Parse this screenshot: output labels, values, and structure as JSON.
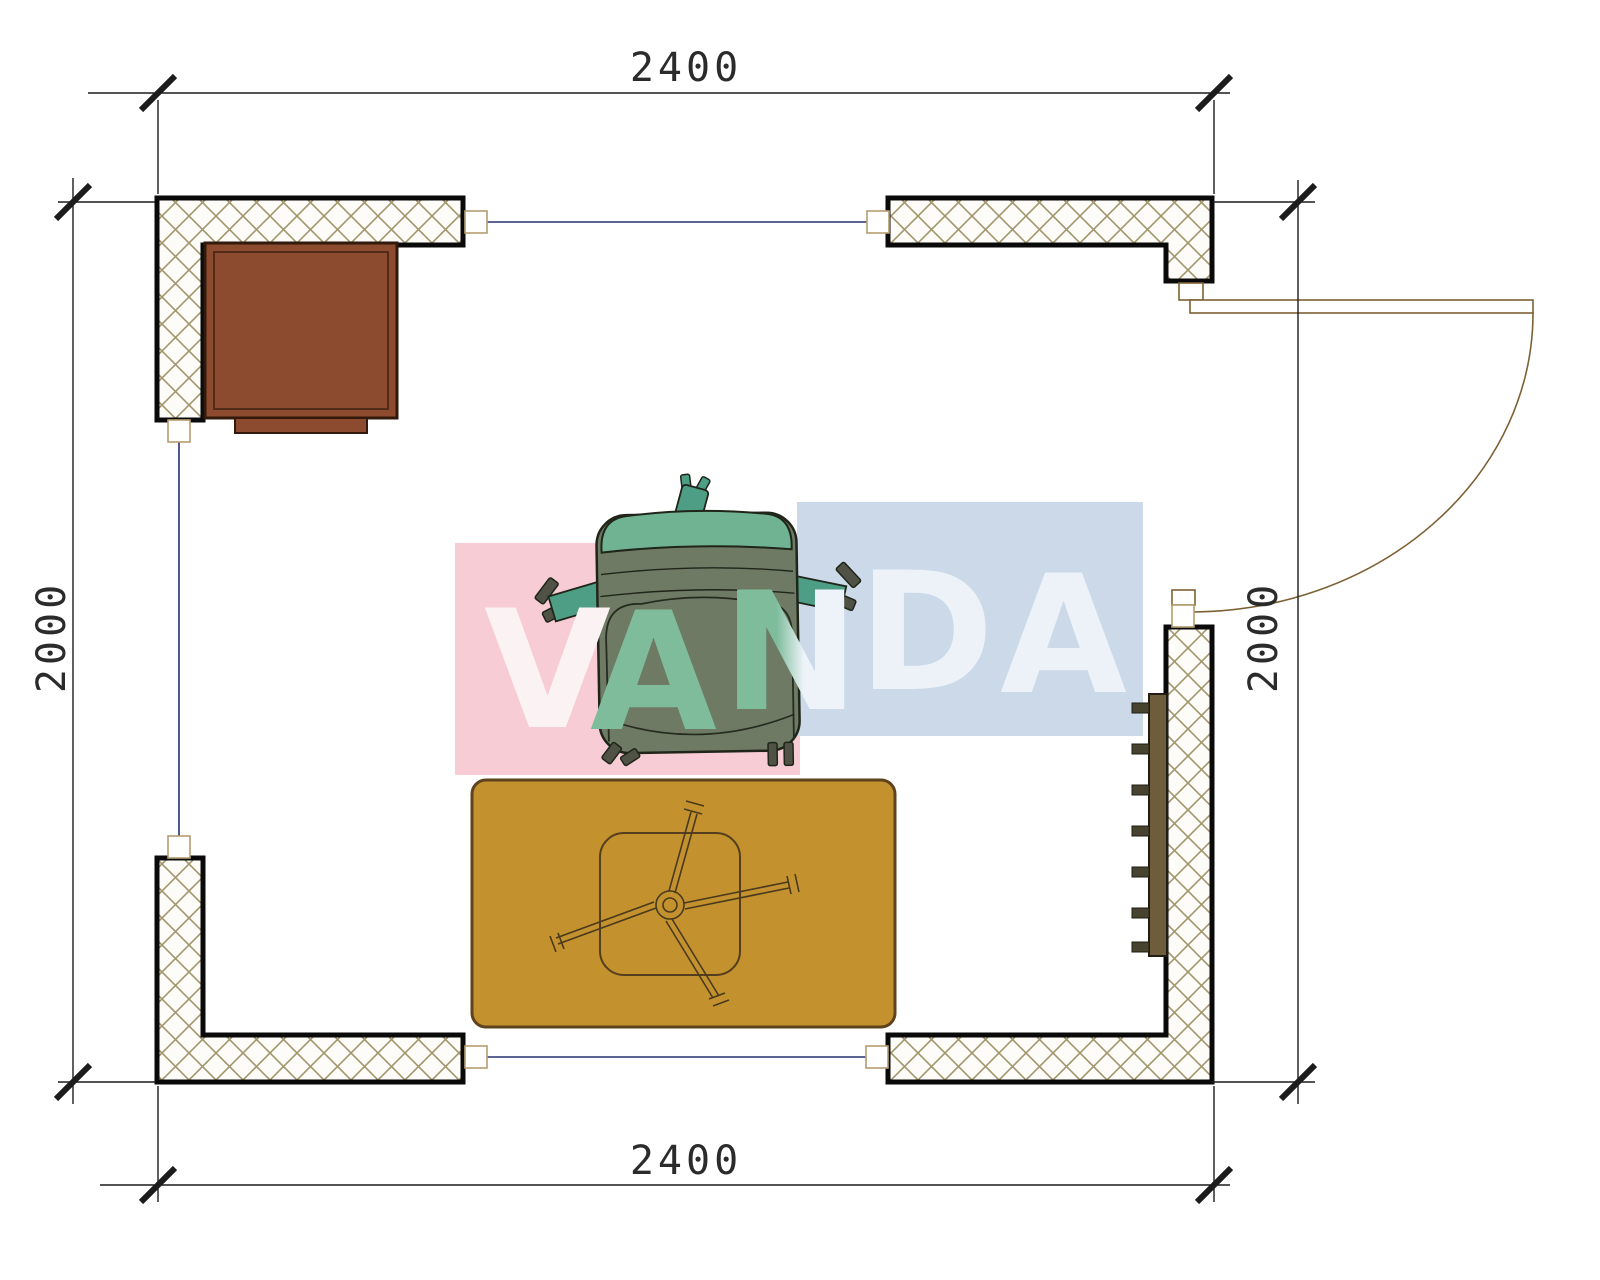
{
  "plan": {
    "type": "floor-plan",
    "dimensions": {
      "top": "2400",
      "bottom": "2400",
      "left": "2000",
      "right": "2000"
    },
    "watermark": {
      "text": "VANDA",
      "letters": [
        {
          "char": "V",
          "color": "#fbf2f4"
        },
        {
          "char": "A",
          "color": "#7fbc9c"
        },
        {
          "char": "N",
          "color": "#dce9e6",
          "gradient": [
            "#7fbc9c",
            "#eef3fa"
          ]
        },
        {
          "char": "D",
          "color": "#edf2f9"
        },
        {
          "char": "A",
          "color": "#edf2f9"
        }
      ],
      "pink_block_color": "#f8ccd4",
      "blue_block_color": "#ccd9e9"
    },
    "objects": {
      "walls": "hatched-masonry-walls",
      "door": "right-side-swing-door",
      "windows": [
        "top-window",
        "left-window",
        "bottom-window"
      ],
      "desk": "corner-desk",
      "chair": "armchair-top-view",
      "rug": "area-rug",
      "table": "x-leg-low-table",
      "radiator": "wall-radiator"
    },
    "colors": {
      "desk": "#8c4b2e",
      "chair_body": "#6e7a63",
      "chair_back": "#6fb393",
      "chair_arms": "#4e9e86",
      "rug": "#c3922f",
      "radiator": "#6e5d3b",
      "window_line": "#25306e",
      "hatch_line": "#a3966c",
      "wall_outline": "#0a0a0a",
      "door_line": "#7d6134",
      "dimension_line": "#1c1c1c"
    }
  }
}
